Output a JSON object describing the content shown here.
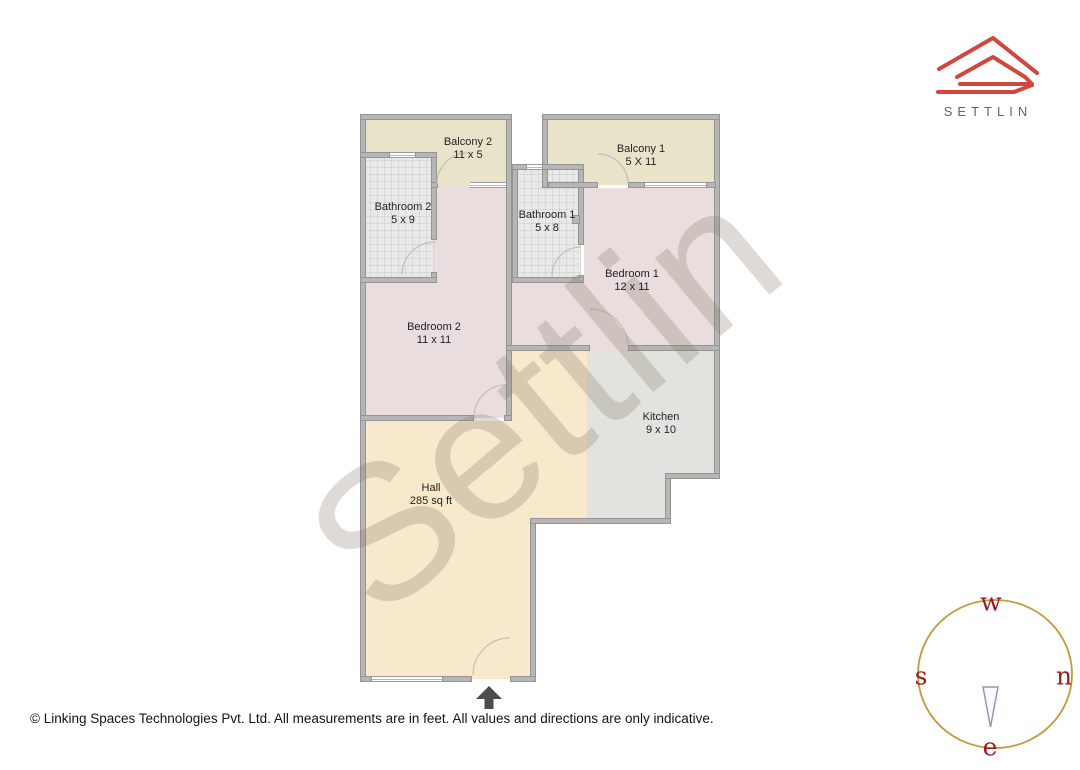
{
  "logo": {
    "brand": "SETTLIN"
  },
  "watermark": {
    "text": "Settlin"
  },
  "rooms": [
    {
      "name": "Balcony 2",
      "dims": "11 x 5"
    },
    {
      "name": "Balcony 1",
      "dims": "5 X 11"
    },
    {
      "name": "Bathroom 2",
      "dims": "5 x 9"
    },
    {
      "name": "Bathroom 1",
      "dims": "5 x 8"
    },
    {
      "name": "Bedroom 1",
      "dims": "12 x 11"
    },
    {
      "name": "Bedroom 2",
      "dims": "11 x 11"
    },
    {
      "name": "Kitchen",
      "dims": "9 x 10"
    },
    {
      "name": "Hall",
      "dims": "285 sq ft"
    }
  ],
  "compass": {
    "top": "w",
    "left": "s",
    "right": "n",
    "bottom": "e"
  },
  "footer": {
    "copyright": "© Linking Spaces Technologies Pvt. Ltd. All measurements are in feet. All values and directions are only indicative."
  },
  "colors": {
    "wall": "#b6b6b6",
    "balcony": "#e9e3ca",
    "bedroom": "#e9dddd",
    "hall": "#f8e8cc",
    "kitchen": "#e1e4de",
    "bathroom": "#e9e9e9",
    "logored": "#d0473f",
    "compassring": "#c39b3a",
    "compassletter": "#991b1e"
  }
}
